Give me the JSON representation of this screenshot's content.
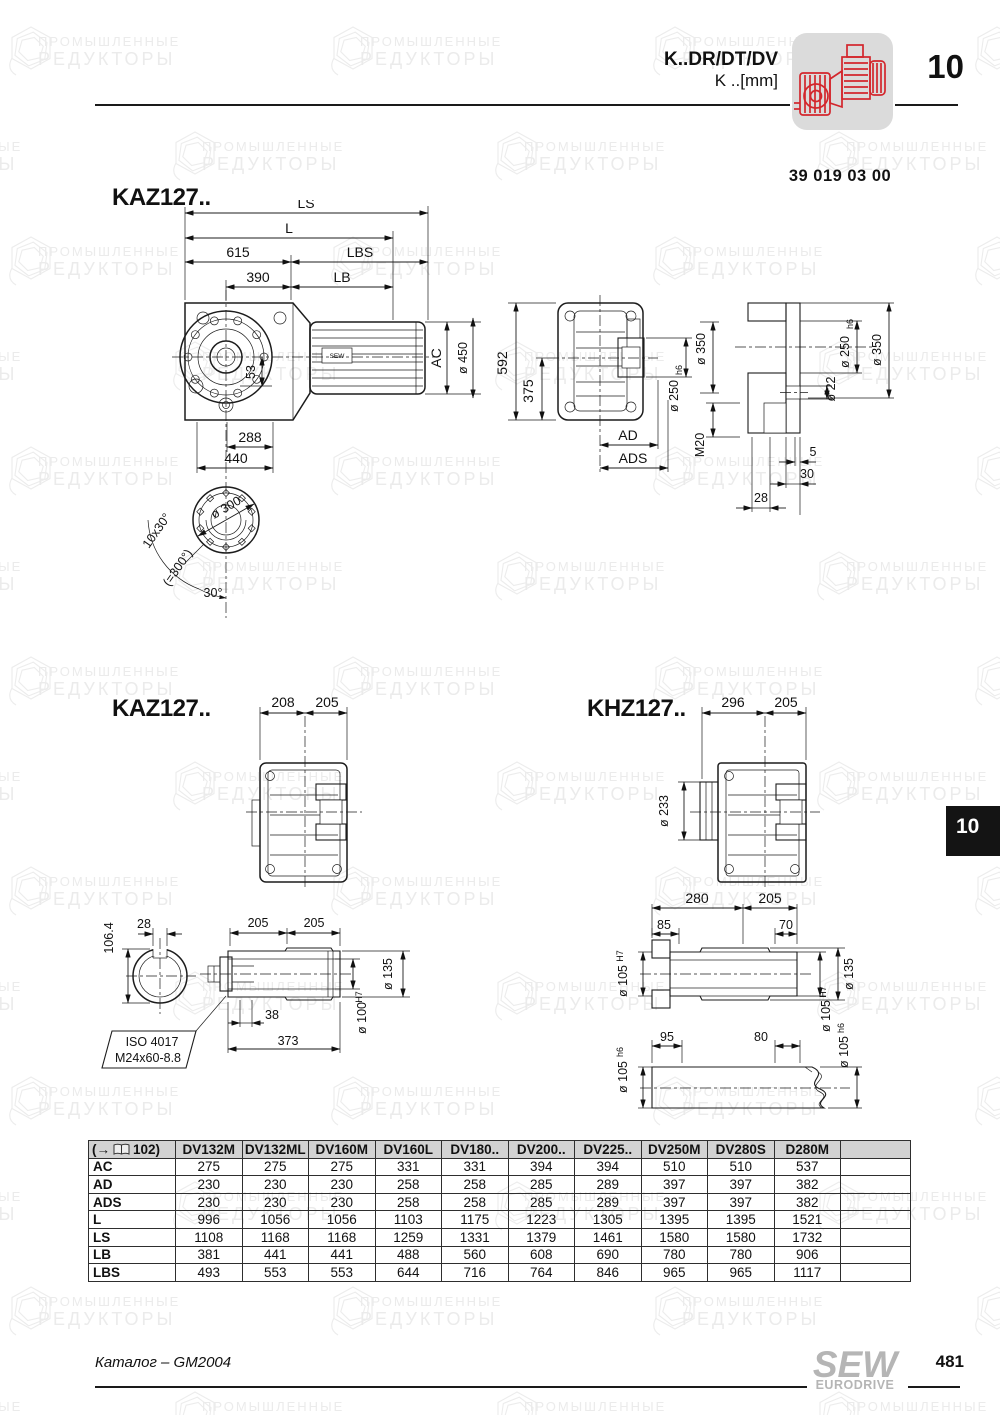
{
  "header": {
    "product": "K..DR/DT/DV",
    "unit": "K ..[mm]",
    "chapter": "10",
    "drawing_number": "39 019 03 00"
  },
  "sections": {
    "s1": "KAZ127..",
    "s2": "KAZ127..",
    "s3": "KHZ127.."
  },
  "watermark": {
    "line1": "ПРОМЫШЛЕННЫЕ",
    "line2": "РЕДУКТОРЫ"
  },
  "d1": {
    "ls": "LS",
    "l": "L",
    "n615": "615",
    "lbs": "LBS",
    "n390": "390",
    "lb": "LB",
    "ac": "AC",
    "d450": "ø 450",
    "n53": "53",
    "n288": "288",
    "n440": "440",
    "n592": "592",
    "n375": "375",
    "d350": "ø 350",
    "d250": "ø 250",
    "fit250": "h6",
    "ad": "AD",
    "ads": "ADS",
    "m20": "M20",
    "d22": "ø 22",
    "d250b": "ø 250",
    "fit250b": "h6",
    "d350b": "ø 350",
    "n5": "5",
    "n30": "30",
    "n28": "28",
    "motor": "SEW",
    "flange": {
      "d300": "ø 300",
      "pat": "10x30°",
      "pat2": "(=300°)",
      "ang": "30°"
    }
  },
  "d2": {
    "n208": "208",
    "n205": "205"
  },
  "d3": {
    "n296": "296",
    "n205": "205",
    "d233": "ø 233"
  },
  "d4": {
    "n106": "106.4",
    "n28": "28",
    "n205a": "205",
    "n205b": "205",
    "d135": "ø 135",
    "d100": "ø 100",
    "fit100": "H7",
    "n38": "38",
    "n373": "373",
    "iso1": "ISO 4017",
    "iso2": "M24x60-8.8"
  },
  "d5": {
    "n280": "280",
    "n205": "205",
    "n85": "85",
    "n70": "70",
    "d105a": "ø 105",
    "fita": "H7",
    "d135": "ø 135",
    "d105b": "ø 105",
    "fitb": "H7",
    "d105c": "ø 105",
    "fitc": "h6",
    "n95": "95",
    "n80": "80",
    "d105d": "ø 105",
    "fitd": "h6"
  },
  "table": {
    "ref_open": "(→",
    "ref_page": "102)",
    "columns": [
      "DV132M",
      "DV132ML",
      "DV160M",
      "DV160L",
      "DV180..",
      "DV200..",
      "DV225..",
      "DV250M",
      "DV280S",
      "D280M"
    ],
    "rows": [
      {
        "label": "AC",
        "values": [
          275,
          275,
          275,
          331,
          331,
          394,
          394,
          510,
          510,
          537
        ]
      },
      {
        "label": "AD",
        "values": [
          230,
          230,
          230,
          258,
          258,
          285,
          289,
          397,
          397,
          382
        ]
      },
      {
        "label": "ADS",
        "values": [
          230,
          230,
          230,
          258,
          258,
          285,
          289,
          397,
          397,
          382
        ]
      },
      {
        "label": "L",
        "values": [
          996,
          1056,
          1056,
          1103,
          1175,
          1223,
          1305,
          1395,
          1395,
          1521
        ]
      },
      {
        "label": "LS",
        "values": [
          1108,
          1168,
          1168,
          1259,
          1331,
          1379,
          1461,
          1580,
          1580,
          1732
        ]
      },
      {
        "label": "LB",
        "values": [
          381,
          441,
          441,
          488,
          560,
          608,
          690,
          780,
          780,
          906
        ]
      },
      {
        "label": "LBS",
        "values": [
          493,
          553,
          553,
          644,
          716,
          764,
          846,
          965,
          965,
          1117
        ]
      }
    ]
  },
  "sidebar_tab": "10",
  "footer": {
    "catalog": "Каталог – GM2004",
    "page": "481",
    "logo1": "SEW",
    "logo2": "EURODRIVE"
  },
  "colors": {
    "accent_red": "#d3262c",
    "tab_black": "#141414",
    "table_header_bg": "#d2d2d2",
    "watermark_gray": "#ebebeb"
  }
}
